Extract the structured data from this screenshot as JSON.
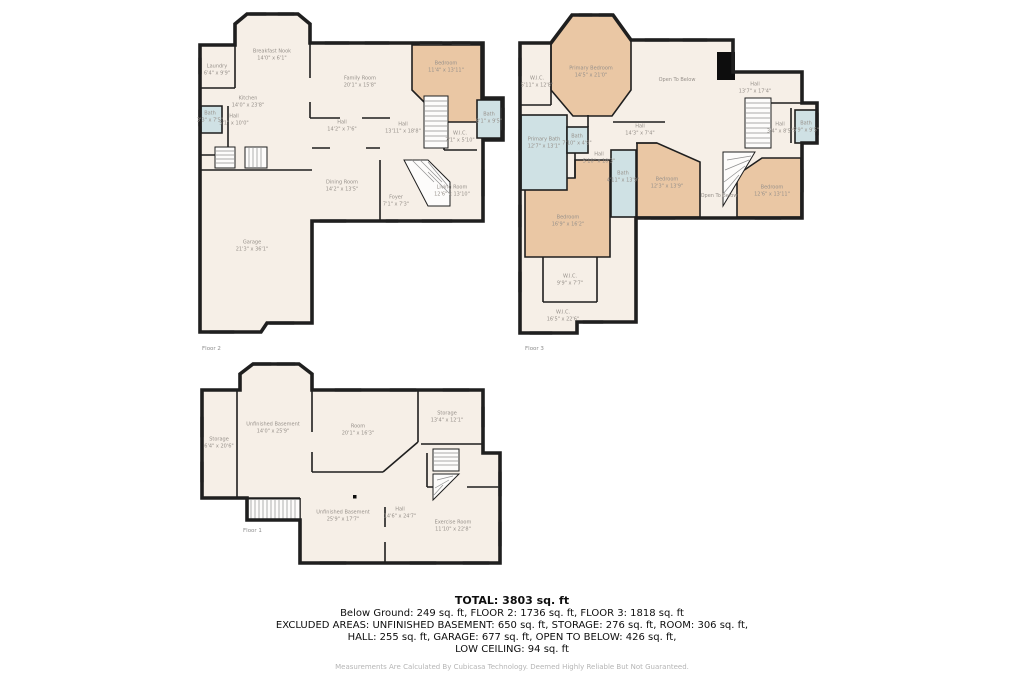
{
  "colors": {
    "room_fill": "#f6efe7",
    "bedroom_fill": "#eac7a4",
    "bath_fill": "#cfe1e4",
    "wall": "#1f1f1f",
    "label_text": "#97918b"
  },
  "floors": [
    {
      "caption": "Floor 2",
      "rooms": {
        "breakfast_nook": {
          "name": "Breakfast Nook",
          "dims": "14'0\" x 6'1\""
        },
        "laundry": {
          "name": "Laundry",
          "dims": "6'4\" x 9'9\""
        },
        "kitchen": {
          "name": "Kitchen",
          "dims": "14'0\" x 23'8\""
        },
        "family_room": {
          "name": "Family Room",
          "dims": "20'1\" x 15'8\""
        },
        "bedroom": {
          "name": "Bedroom",
          "dims": "11'4\" x 13'11\""
        },
        "bath_left": {
          "name": "Bath",
          "dims": "3'3\" x 7'5\""
        },
        "hall_left": {
          "name": "Hall",
          "dims": "5'1\" x 10'0\""
        },
        "hall_center": {
          "name": "Hall",
          "dims": "14'2\" x 7'6\""
        },
        "hall_right": {
          "name": "Hall",
          "dims": "13'11\" x 18'8\""
        },
        "wic": {
          "name": "W.I.C.",
          "dims": "7'1\" x 5'10\""
        },
        "bath_right": {
          "name": "Bath",
          "dims": "8'1\" x 9'5\""
        },
        "dining_room": {
          "name": "Dining Room",
          "dims": "14'2\" x 13'5\""
        },
        "foyer": {
          "name": "Foyer",
          "dims": "7'1\" x 7'3\""
        },
        "living_room": {
          "name": "Living Room",
          "dims": "12'6\" x 13'10\""
        },
        "garage": {
          "name": "Garage",
          "dims": "21'3\" x 36'1\""
        }
      }
    },
    {
      "caption": "Floor 3",
      "rooms": {
        "wic_top": {
          "name": "W.I.C.",
          "dims": "5'11\" x 12'8\""
        },
        "primary_bedroom": {
          "name": "Primary Bedroom",
          "dims": "14'5\" x 21'0\""
        },
        "open_below_1": {
          "name": "Open To Below",
          "dims": ""
        },
        "hall_top": {
          "name": "Hall",
          "dims": "13'7\" x 17'4\""
        },
        "hall_small": {
          "name": "Hall",
          "dims": "3'4\" x 8'5\""
        },
        "bath_right": {
          "name": "Bath",
          "dims": "5'9\" x 9'5\""
        },
        "primary_bath": {
          "name": "Primary Bath",
          "dims": "12'7\" x 13'1\""
        },
        "bath_small": {
          "name": "Bath",
          "dims": "7'10\" x 4'9\""
        },
        "hall_mid": {
          "name": "Hall",
          "dims": "5'10\" x 10'3\""
        },
        "hall_center": {
          "name": "Hall",
          "dims": "14'3\" x 7'4\""
        },
        "bath_vertical": {
          "name": "Bath",
          "dims": "4'11\" x 13'9\""
        },
        "bedroom_middle": {
          "name": "Bedroom",
          "dims": "12'3\" x 13'9\""
        },
        "open_below_2": {
          "name": "Open To Below",
          "dims": ""
        },
        "bedroom_right": {
          "name": "Bedroom",
          "dims": "12'6\" x 13'11\""
        },
        "bedroom_left": {
          "name": "Bedroom",
          "dims": "16'9\" x 16'2\""
        },
        "wic_mid": {
          "name": "W.I.C.",
          "dims": "9'9\" x 7'7\""
        },
        "wic_bottom": {
          "name": "W.I.C.",
          "dims": "16'5\" x 22'6\""
        }
      }
    },
    {
      "caption": "Floor 1",
      "rooms": {
        "storage_left": {
          "name": "Storage",
          "dims": "6'4\" x 20'6\""
        },
        "unfinished_top": {
          "name": "Unfinished Basement",
          "dims": "14'0\" x 25'9\""
        },
        "room": {
          "name": "Room",
          "dims": "20'1\" x 16'3\""
        },
        "storage_right": {
          "name": "Storage",
          "dims": "13'4\" x 12'1\""
        },
        "unfinished_bottom": {
          "name": "Unfinished Basement",
          "dims": "25'9\" x 17'7\""
        },
        "hall": {
          "name": "Hall",
          "dims": "14'6\" x 24'7\""
        },
        "exercise_room": {
          "name": "Exercise Room",
          "dims": "11'10\" x 22'8\""
        }
      }
    }
  ],
  "summary": {
    "total": "TOTAL: 3803 sq. ft",
    "line1": "Below Ground: 249 sq. ft, FLOOR 2: 1736 sq. ft, FLOOR 3: 1818 sq. ft",
    "line2": "EXCLUDED AREAS: UNFINISHED BASEMENT: 650 sq. ft, STORAGE: 276 sq. ft, ROOM: 306 sq. ft,",
    "line3": "HALL: 255 sq. ft, GARAGE: 677 sq. ft, OPEN TO BELOW: 426 sq. ft,",
    "line4": "LOW CEILING: 94 sq. ft"
  },
  "disclaimer": "Measurements Are Calculated By Cubicasa Technology. Deemed Highly Reliable But Not Guaranteed."
}
